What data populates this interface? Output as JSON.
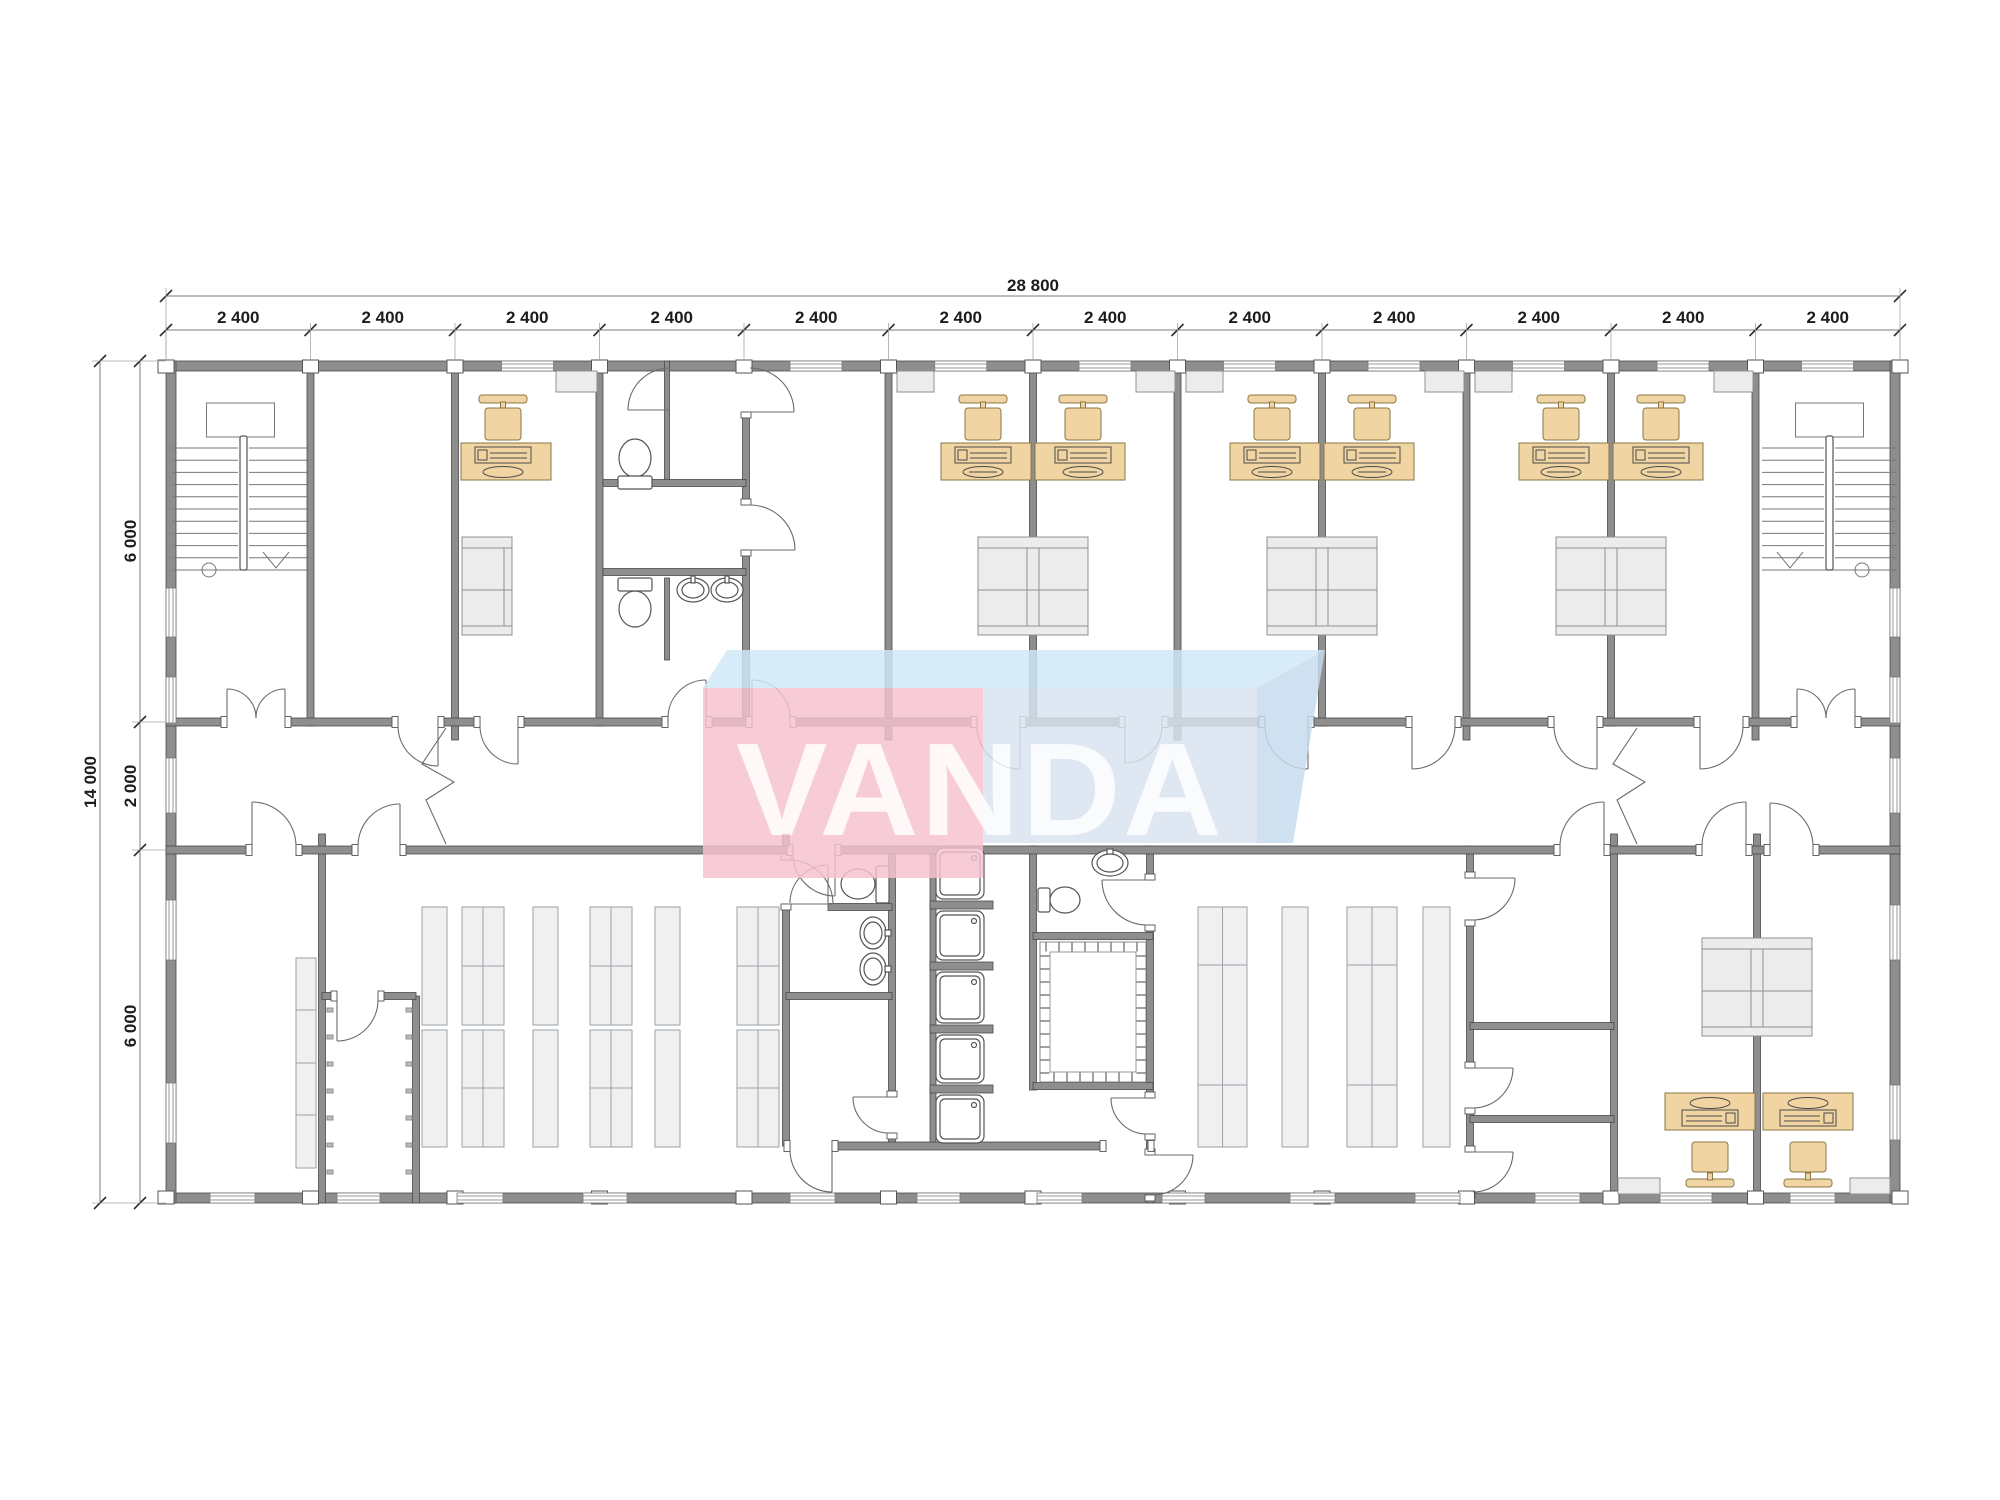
{
  "drawing": {
    "type": "floor-plan",
    "building_total_width_mm": "28 800",
    "building_total_depth_mm": "14 000"
  },
  "dimensions": {
    "total_width_label": "28 800",
    "bay_labels": [
      "2 400",
      "2 400",
      "2 400",
      "2 400",
      "2 400",
      "2 400",
      "2 400",
      "2 400",
      "2 400",
      "2 400",
      "2 400",
      "2 400"
    ],
    "total_height_label": "14 000",
    "left_segment_labels": [
      "6 000",
      "2 000",
      "6 000"
    ]
  },
  "watermark": {
    "text": "VANDA"
  },
  "palette": {
    "wall": "#8e8e8e",
    "wall_edge": "#4a4a4a",
    "desk_fill": "#f0d5a2",
    "desk_edge": "#8a7747",
    "furniture_fill": "#ececec",
    "watermark_pink": "#f6c2cf",
    "watermark_blue": "#d9e3f0",
    "watermark_blue_light": "#cfe9f7",
    "watermark_facet_blue": "#c6dbee",
    "dim_text": "#1c1c1c"
  }
}
